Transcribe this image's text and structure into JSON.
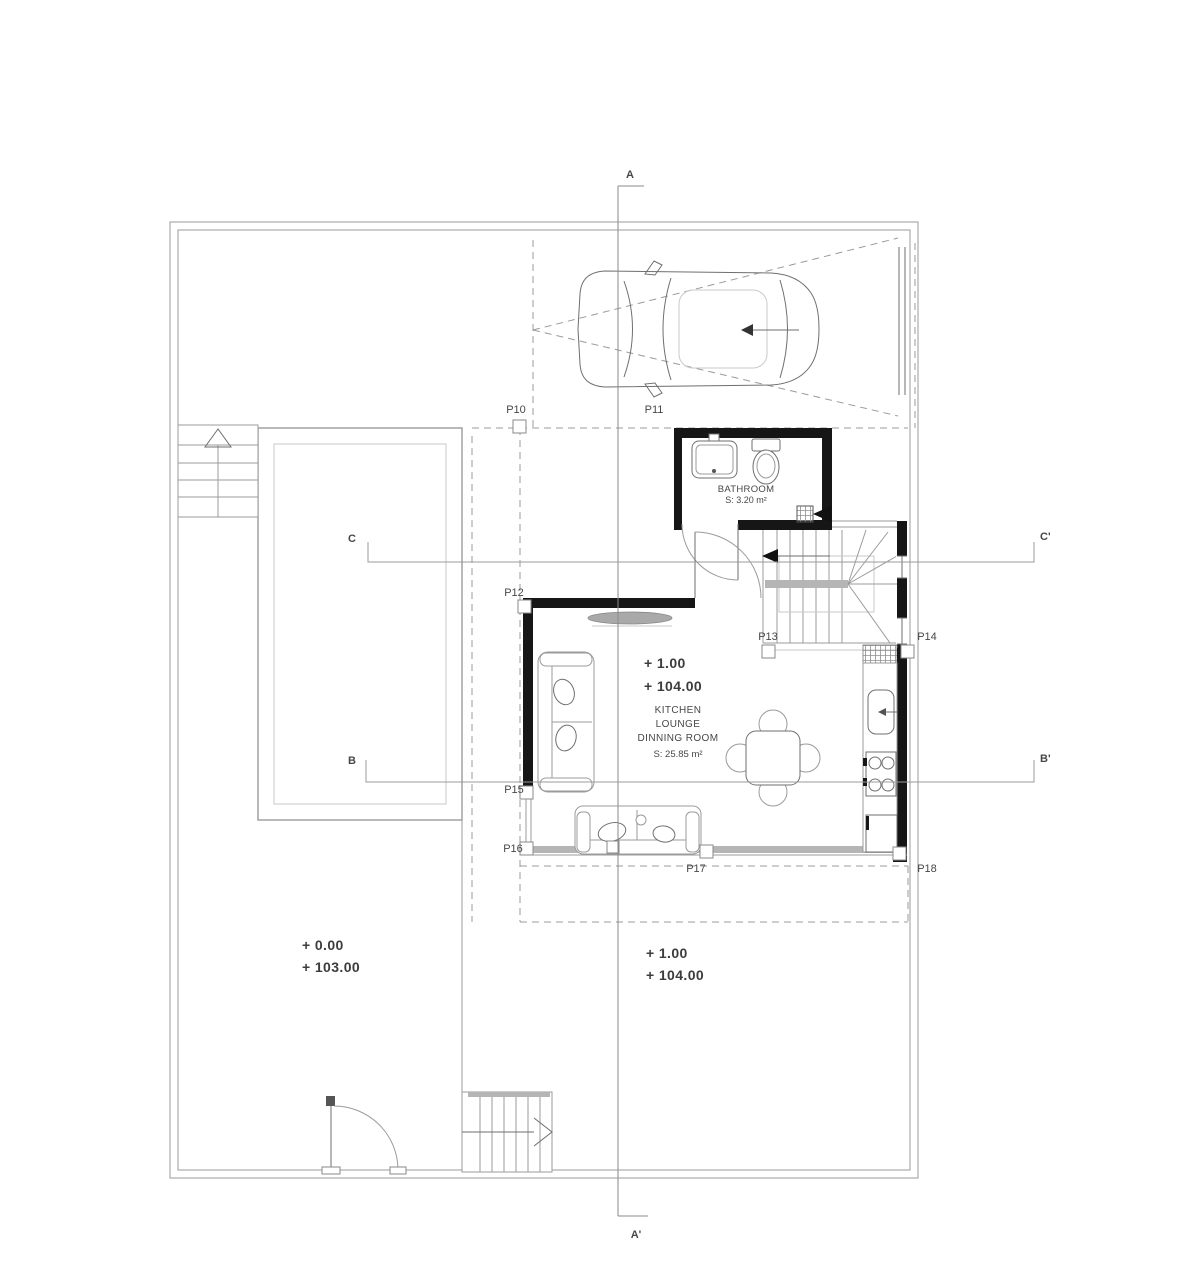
{
  "document": {
    "type": "architectural-ground-floor-plan"
  },
  "sections": {
    "a": "A",
    "a_prime": "A'",
    "b": "B",
    "b_prime": "B'",
    "c": "C",
    "c_prime": "C'"
  },
  "markers": {
    "p10": "P10",
    "p11": "P11",
    "p12": "P12",
    "p13": "P13",
    "p14": "P14",
    "p15": "P15",
    "p16": "P16",
    "p17": "P17",
    "p18": "P18"
  },
  "rooms": {
    "bathroom": {
      "name": "BATHROOM",
      "area": "S: 3.20 m²"
    },
    "kitchen_lounge": {
      "name_line1": "KITCHEN",
      "name_line2": "LOUNGE",
      "name_line3": "DINNING ROOM",
      "area": "S: 25.85 m²"
    }
  },
  "levels": {
    "plot_relative": "+ 0.00",
    "plot_absolute": "+ 103.00",
    "terrace_relative": "+ 1.00",
    "terrace_absolute": "+ 104.00",
    "interior_relative": "+ 1.00",
    "interior_absolute": "+ 104.00"
  },
  "colors": {
    "wall": "#161616",
    "line": "#9b9b9b",
    "line_dark": "#6f6f6f",
    "line_light": "#c9c9c9",
    "brick": "#e3e3e3",
    "band": "#b5b5b5",
    "text": "#474747"
  }
}
